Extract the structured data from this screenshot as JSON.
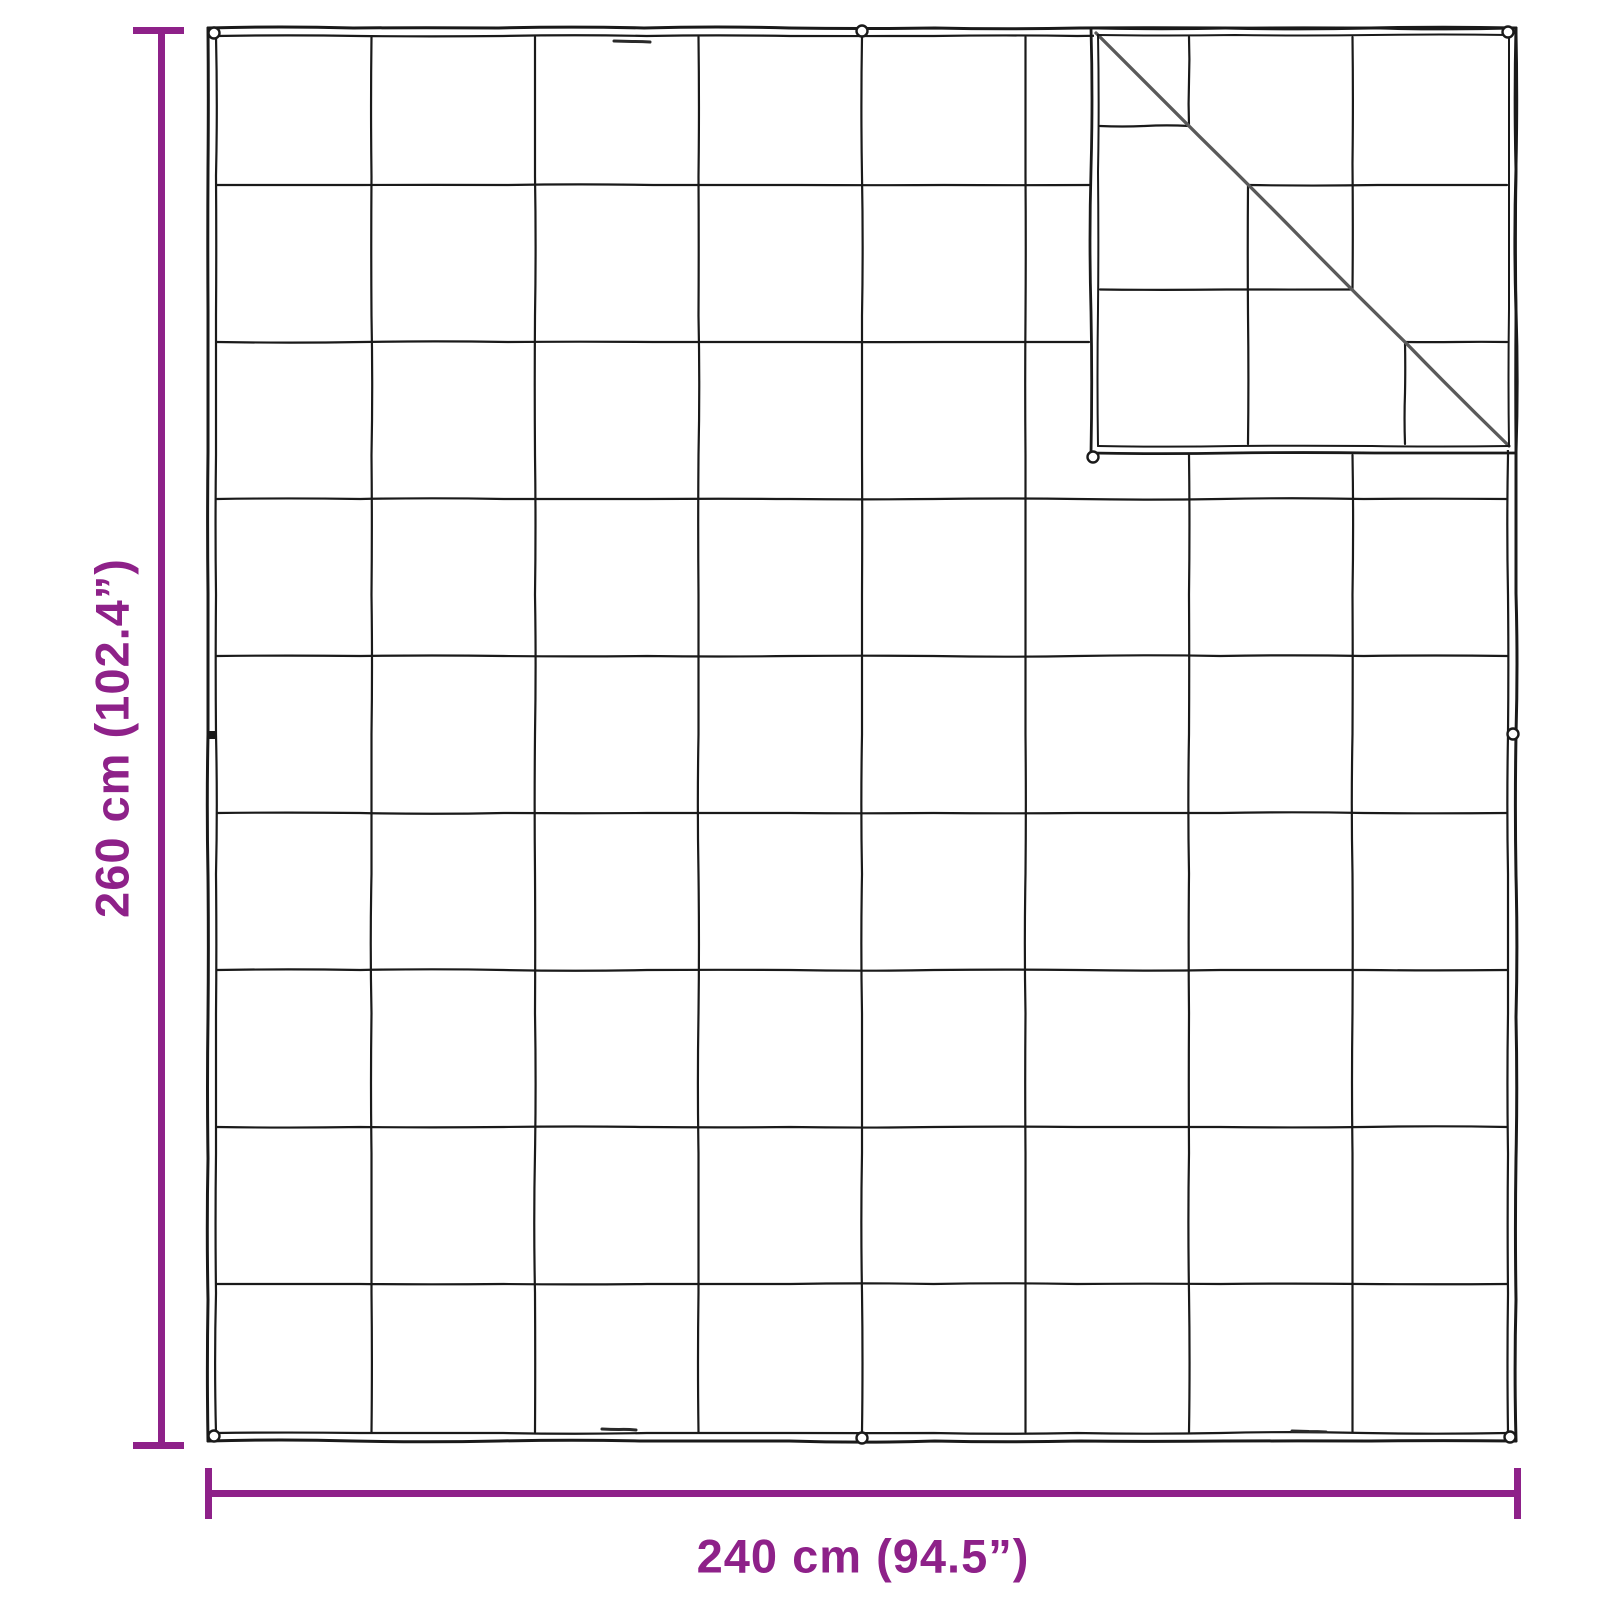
{
  "diagram": {
    "type": "product-dimension-diagram",
    "subject": "quilted weighted blanket with folded top-right corner",
    "height_label": "260 cm (102.4”)",
    "width_label": "240 cm (94.5”)",
    "height_cm": "260 cm",
    "height_inches": "102.4”",
    "width_cm": "240 cm",
    "width_inches": "94.5”",
    "quilt_grid": {
      "columns": 8,
      "rows": 9
    },
    "folded_corner": "top-right",
    "colors": {
      "dimension_accent": "#8E2189",
      "blanket_line": "#1a1a1a",
      "fold_crease": "#5a5a5a",
      "background": "#ffffff"
    }
  }
}
